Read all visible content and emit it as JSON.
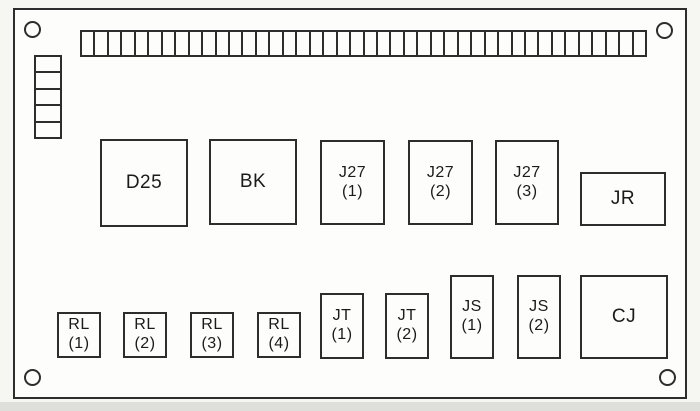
{
  "colors": {
    "line": "#2d2d2d",
    "panel_background": "#fdfdfb",
    "page_background": "#f6f6f2",
    "text": "#1b1b1b"
  },
  "terminal_strip": {
    "cell_count": 42
  },
  "left_connector": {
    "cell_count": 5
  },
  "mounting_hole_count": 4,
  "components": {
    "d25": {
      "label": "D25"
    },
    "bk": {
      "label": "BK"
    },
    "j27_1": {
      "line1": "J27",
      "line2": "(1)"
    },
    "j27_2": {
      "line1": "J27",
      "line2": "(2)"
    },
    "j27_3": {
      "line1": "J27",
      "line2": "(3)"
    },
    "jr": {
      "label": "JR"
    },
    "rl_1": {
      "line1": "RL",
      "line2": "(1)"
    },
    "rl_2": {
      "line1": "RL",
      "line2": "(2)"
    },
    "rl_3": {
      "line1": "RL",
      "line2": "(3)"
    },
    "rl_4": {
      "line1": "RL",
      "line2": "(4)"
    },
    "jt_1": {
      "line1": "JT",
      "line2": "(1)"
    },
    "jt_2": {
      "line1": "JT",
      "line2": "(2)"
    },
    "js_1": {
      "line1": "JS",
      "line2": "(1)"
    },
    "js_2": {
      "line1": "JS",
      "line2": "(2)"
    },
    "cj": {
      "label": "CJ"
    }
  }
}
